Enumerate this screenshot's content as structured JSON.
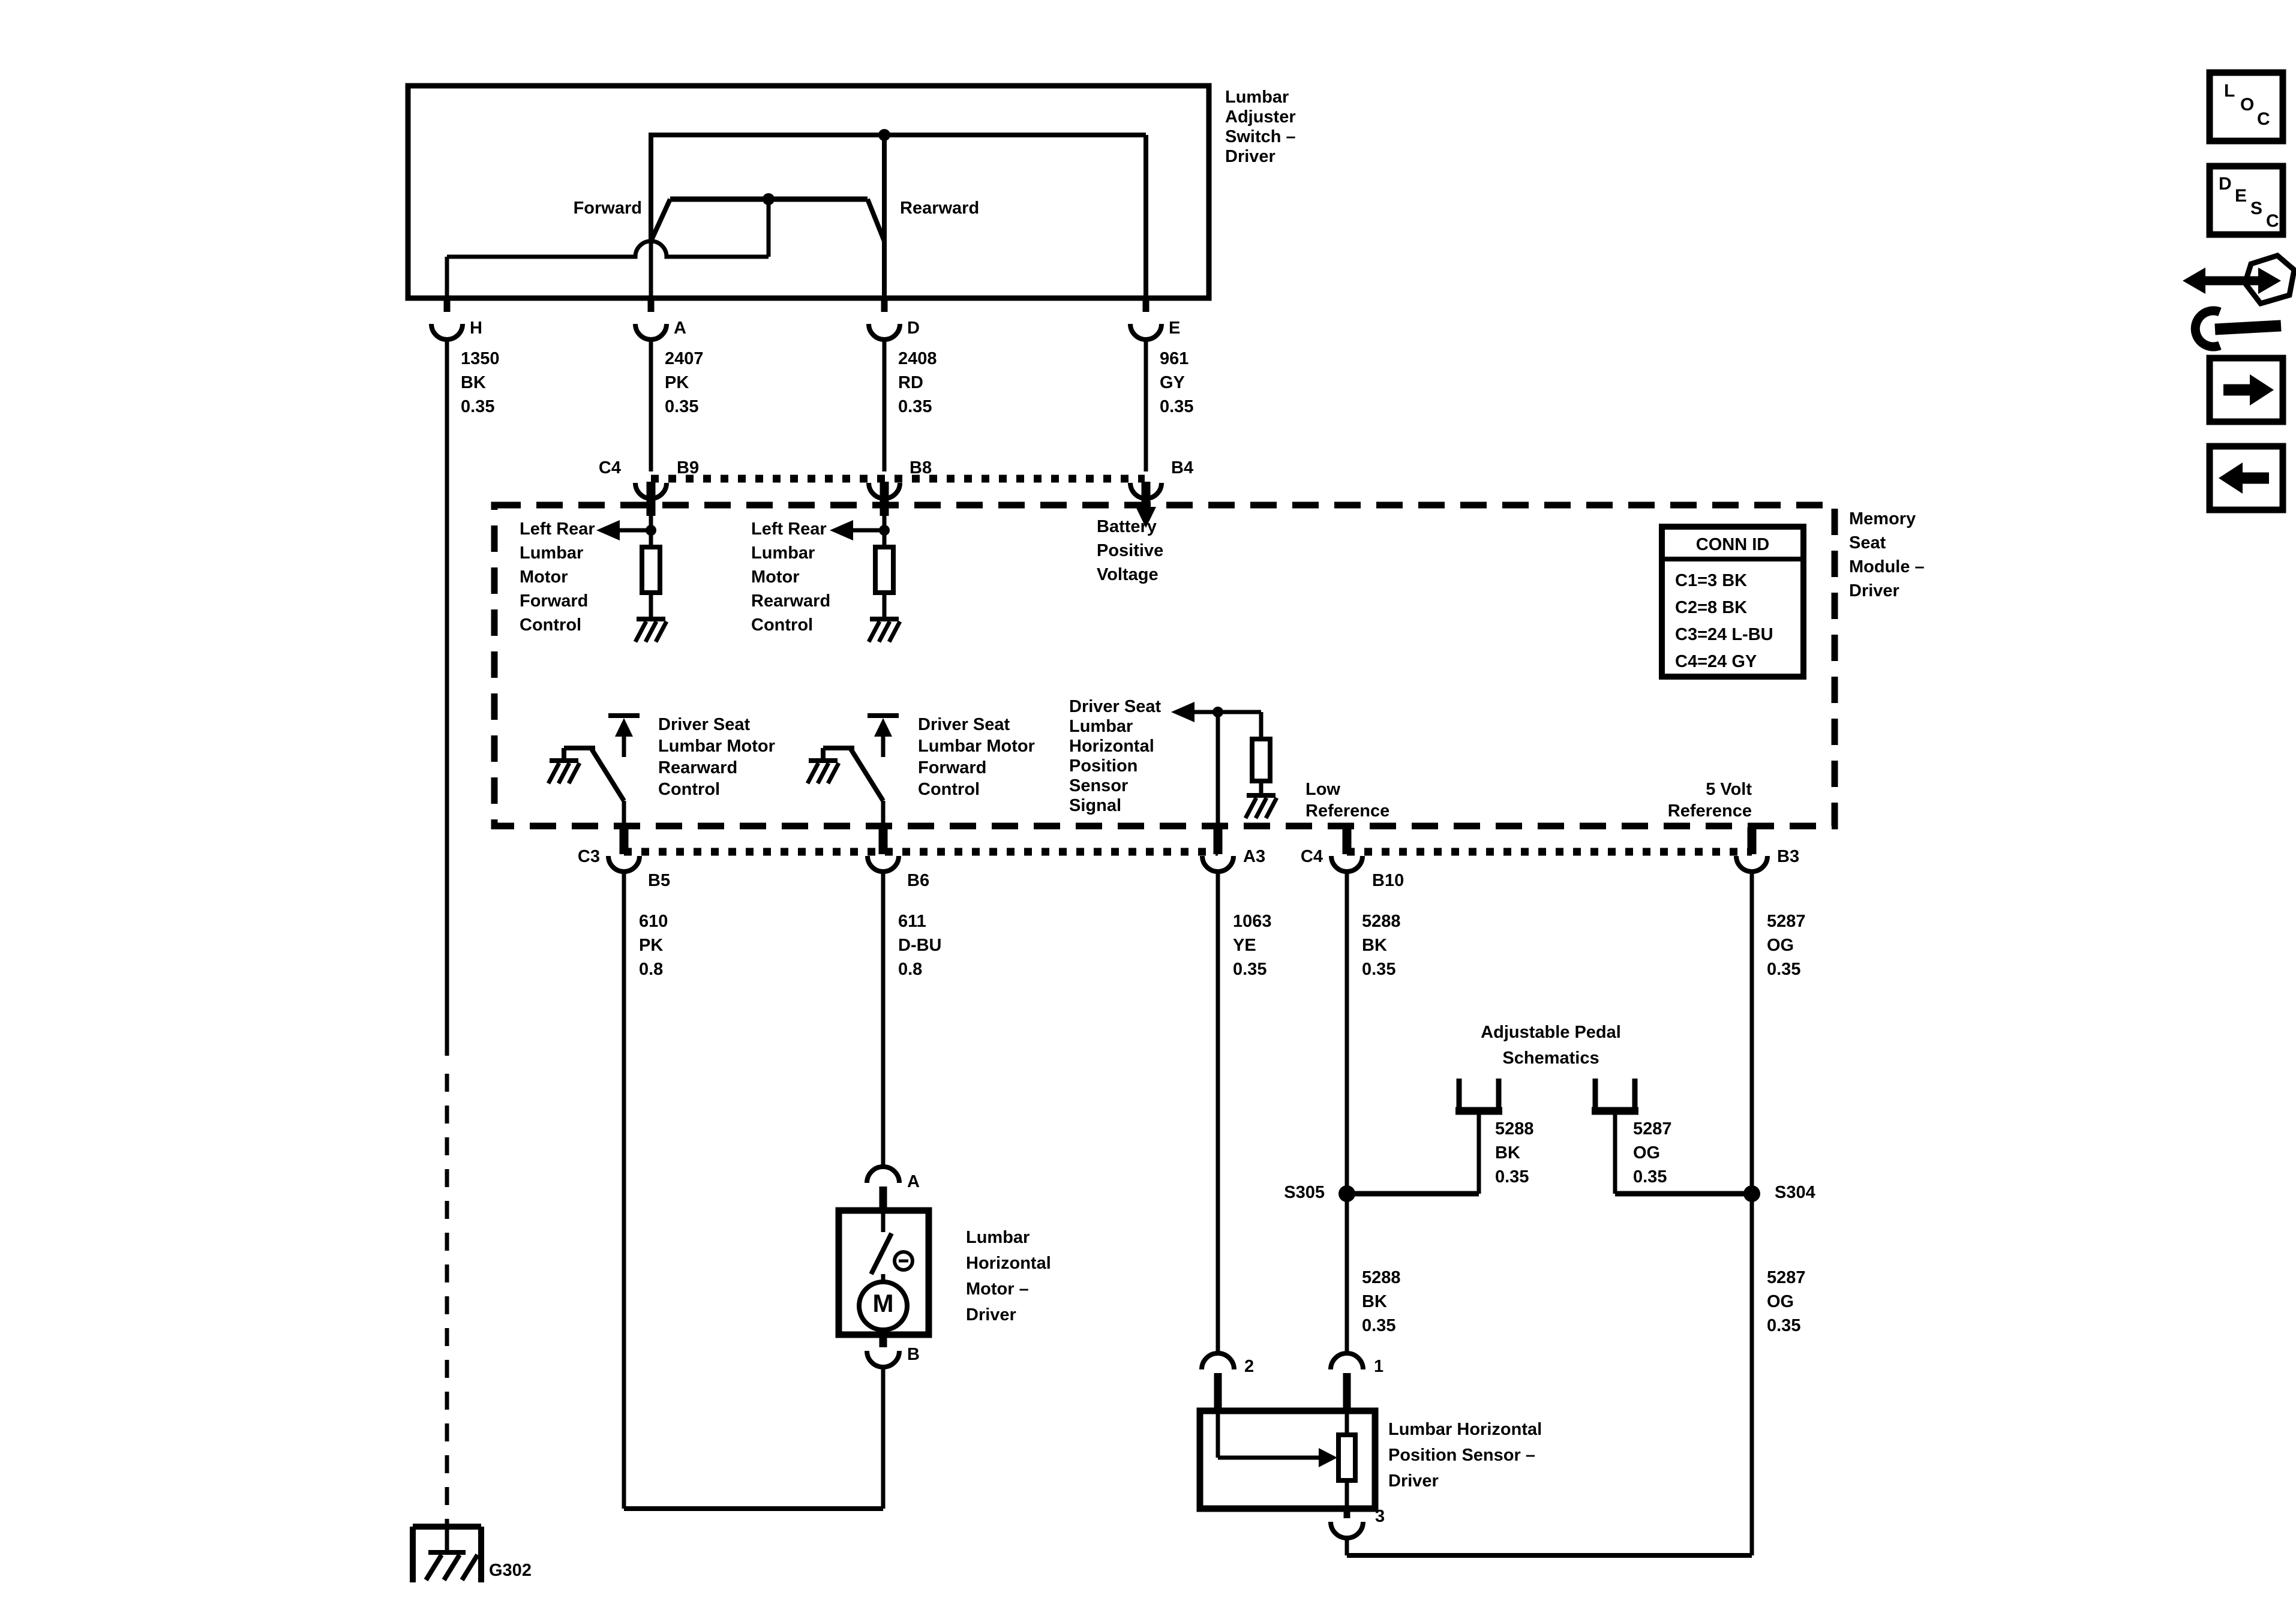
{
  "switch": {
    "title": "Lumbar\nAdjuster\nSwitch –\nDriver",
    "forward": "Forward",
    "rearward": "Rearward",
    "pin_h": "H",
    "pin_a": "A",
    "pin_d": "D",
    "pin_e": "E"
  },
  "wires_top": {
    "h": "1350\nBK\n0.35",
    "a": "2407\nPK\n0.35",
    "d": "2408\nRD\n0.35",
    "e": "961\nGY\n0.35"
  },
  "conn_top": {
    "c4": "C4",
    "b9": "B9",
    "b8": "B8",
    "b4": "B4"
  },
  "module": {
    "name": "Memory\nSeat\nModule –\nDriver",
    "conn_id_title": "CONN ID",
    "conn_id_rows": "C1=3 BK\nC2=8 BK\nC3=24 L-BU\nC4=24 GY",
    "left_rear_fwd": "Left Rear\nLumbar\nMotor\nForward\nControl",
    "left_rear_rwd": "Left Rear\nLumbar\nMotor\nRearward\nControl",
    "battery": "Battery\nPositive\nVoltage",
    "ds_rearward": "Driver Seat\nLumbar Motor\nRearward\nControl",
    "ds_forward": "Driver Seat\nLumbar Motor\nForward\nControl",
    "ds_signal": "Driver Seat\nLumbar\nHorizontal\nPosition\nSensor\nSignal",
    "low_ref": "Low\nReference",
    "five_v_ref": "5 Volt\nReference"
  },
  "conn_bottom": {
    "c3": "C3",
    "b5": "B5",
    "b6": "B6",
    "a3": "A3",
    "c4": "C4",
    "b10": "B10",
    "b3": "B3"
  },
  "wires_bottom": {
    "b5": "610\nPK\n0.8",
    "b6": "611\nD-BU\n0.8",
    "a3": "1063\nYE\n0.35",
    "b10": "5288\nBK\n0.35",
    "b3": "5287\nOG\n0.35"
  },
  "pedal": {
    "title": "Adjustable Pedal\nSchematics",
    "branch_left": "5288\nBK\n0.35",
    "branch_right": "5287\nOG\n0.35",
    "s305": "S305",
    "s304": "S304",
    "below_left": "5288\nBK\n0.35",
    "below_right": "5287\nOG\n0.35"
  },
  "motor": {
    "pin_a": "A",
    "pin_b": "B",
    "m": "M",
    "name": "Lumbar\nHorizontal\nMotor –\nDriver"
  },
  "sensor": {
    "pin2": "2",
    "pin1": "1",
    "pin3": "3",
    "name": "Lumbar Horizontal\nPosition Sensor –\nDriver"
  },
  "ground": {
    "g302": "G302"
  },
  "sidebar": {
    "loc": [
      "L",
      "O",
      "C"
    ],
    "desc": [
      "D",
      "E",
      "S",
      "C"
    ]
  },
  "colors": {
    "line": "#000000",
    "background": "#ffffff"
  }
}
